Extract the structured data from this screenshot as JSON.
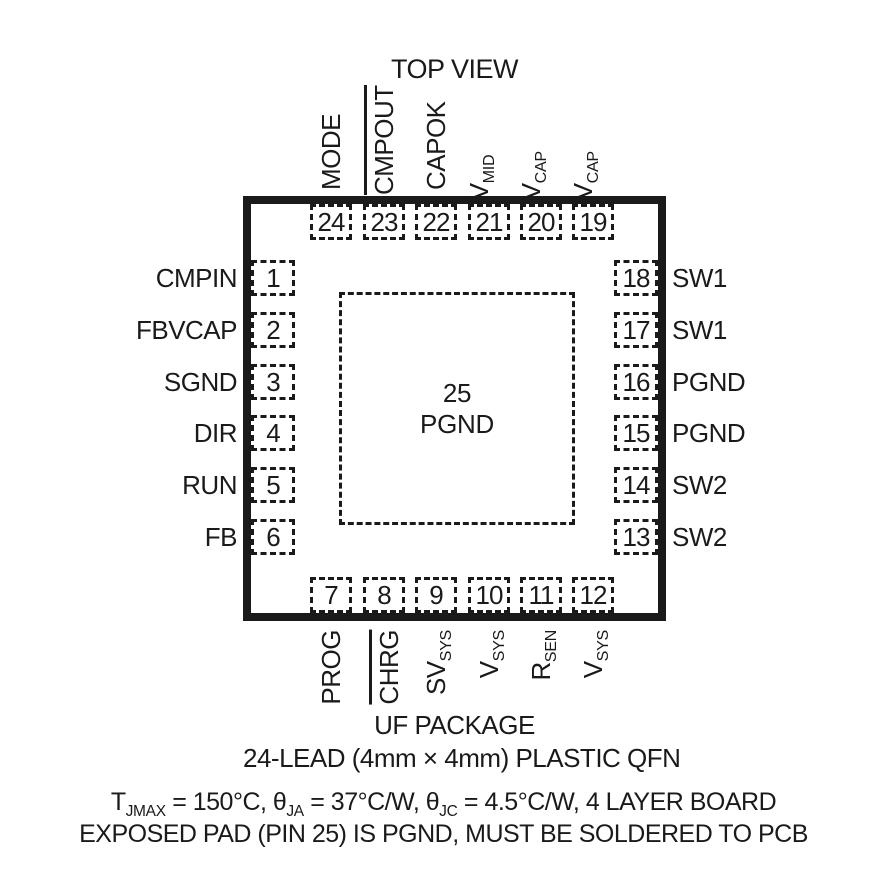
{
  "title": "TOP VIEW",
  "package": {
    "center_pad": {
      "number": "25",
      "label": "PGND"
    }
  },
  "pins": {
    "top": [
      {
        "number": "24",
        "label": "MODE"
      },
      {
        "number": "23",
        "label": "CMPOUT",
        "overline": true
      },
      {
        "number": "22",
        "label": "CAPOK"
      },
      {
        "number": "21",
        "label": "V",
        "sub": "MID"
      },
      {
        "number": "20",
        "label": "V",
        "sub": "CAP"
      },
      {
        "number": "19",
        "label": "V",
        "sub": "CAP"
      }
    ],
    "left": [
      {
        "number": "1",
        "label": "CMPIN"
      },
      {
        "number": "2",
        "label": "FBVCAP"
      },
      {
        "number": "3",
        "label": "SGND"
      },
      {
        "number": "4",
        "label": "DIR"
      },
      {
        "number": "5",
        "label": "RUN"
      },
      {
        "number": "6",
        "label": "FB"
      }
    ],
    "right": [
      {
        "number": "18",
        "label": "SW1"
      },
      {
        "number": "17",
        "label": "SW1"
      },
      {
        "number": "16",
        "label": "PGND"
      },
      {
        "number": "15",
        "label": "PGND"
      },
      {
        "number": "14",
        "label": "SW2"
      },
      {
        "number": "13",
        "label": "SW2"
      }
    ],
    "bottom": [
      {
        "number": "7",
        "label": "PROG"
      },
      {
        "number": "8",
        "label": "CHRG",
        "overline": true
      },
      {
        "number": "9",
        "label": "SV",
        "sub": "SYS"
      },
      {
        "number": "10",
        "label": "V",
        "sub": "SYS"
      },
      {
        "number": "11",
        "label": "R",
        "sub": "SEN"
      },
      {
        "number": "12",
        "label": "V",
        "sub": "SYS"
      }
    ]
  },
  "footer": {
    "package_name": "UF PACKAGE",
    "package_desc": "24-LEAD (4mm × 4mm) PLASTIC QFN",
    "thermal": {
      "t1": "T",
      "s1": "JMAX",
      "t2": " = 150°C, ",
      "t3": "θ",
      "s2": "JA",
      "t4": " = 37°C/W, ",
      "t5": "θ",
      "s3": "JC",
      "t6": " = 4.5°C/W, 4 LAYER BOARD"
    },
    "exposed_pad_note": "EXPOSED PAD (PIN 25) IS PGND, MUST BE SOLDERED TO PCB"
  }
}
